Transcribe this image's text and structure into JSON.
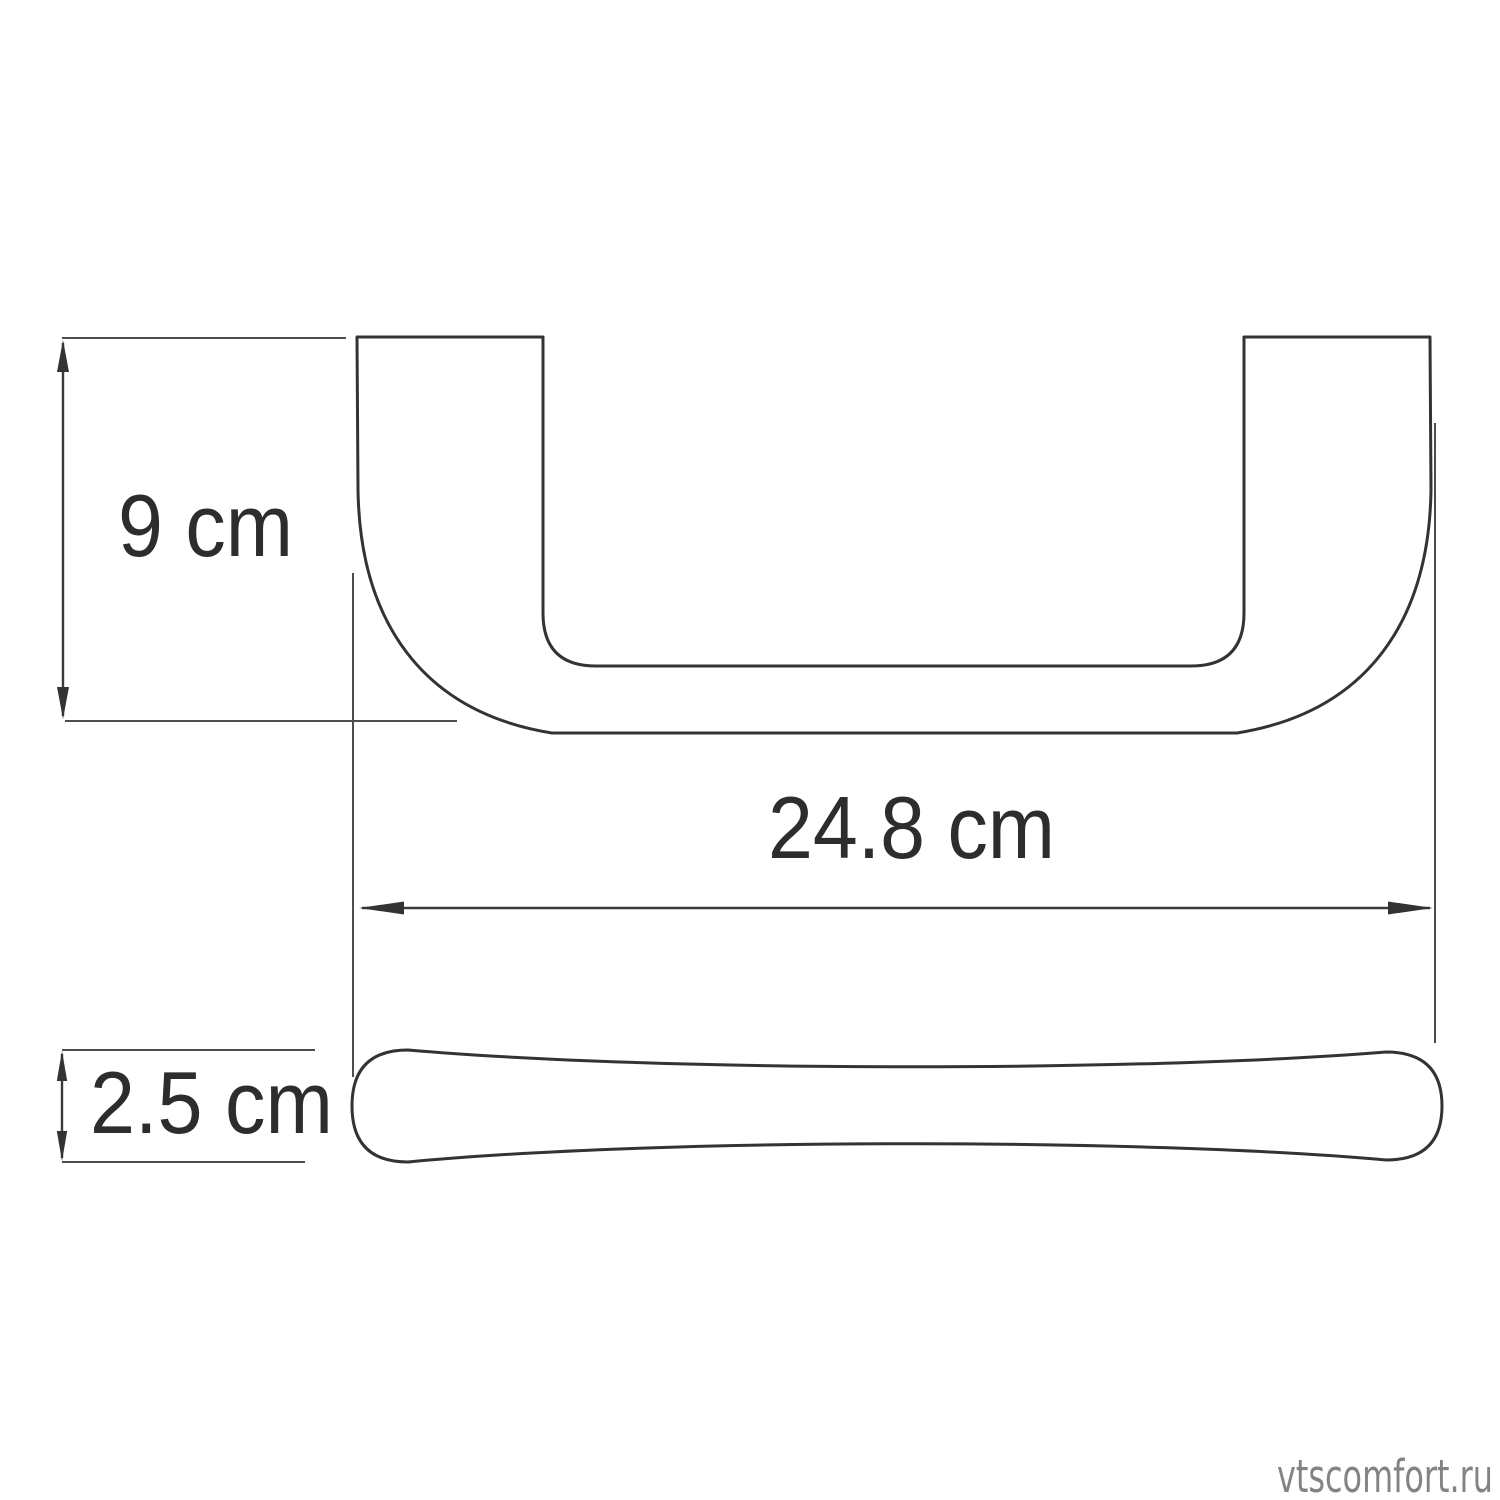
{
  "drawing": {
    "title": "Handle dimension drawing",
    "views": {
      "front": "handle-front-view",
      "side": "handle-side-profile-view"
    },
    "dimensions": {
      "height": {
        "label": "9 cm",
        "value": "9",
        "unit": "cm"
      },
      "length": {
        "label": "24.8 cm",
        "value": "24.8",
        "unit": "cm"
      },
      "depth": {
        "label": "2.5 cm",
        "value": "2.5",
        "unit": "cm"
      }
    },
    "colors": {
      "outline": "#333333",
      "dimension_line": "#3a3a3a",
      "extension_line": "#4d4d4d",
      "text": "#2d2d2d",
      "watermark": "#838383",
      "background": "#ffffff"
    }
  },
  "watermark": {
    "text": "vtscomfort.ru"
  }
}
